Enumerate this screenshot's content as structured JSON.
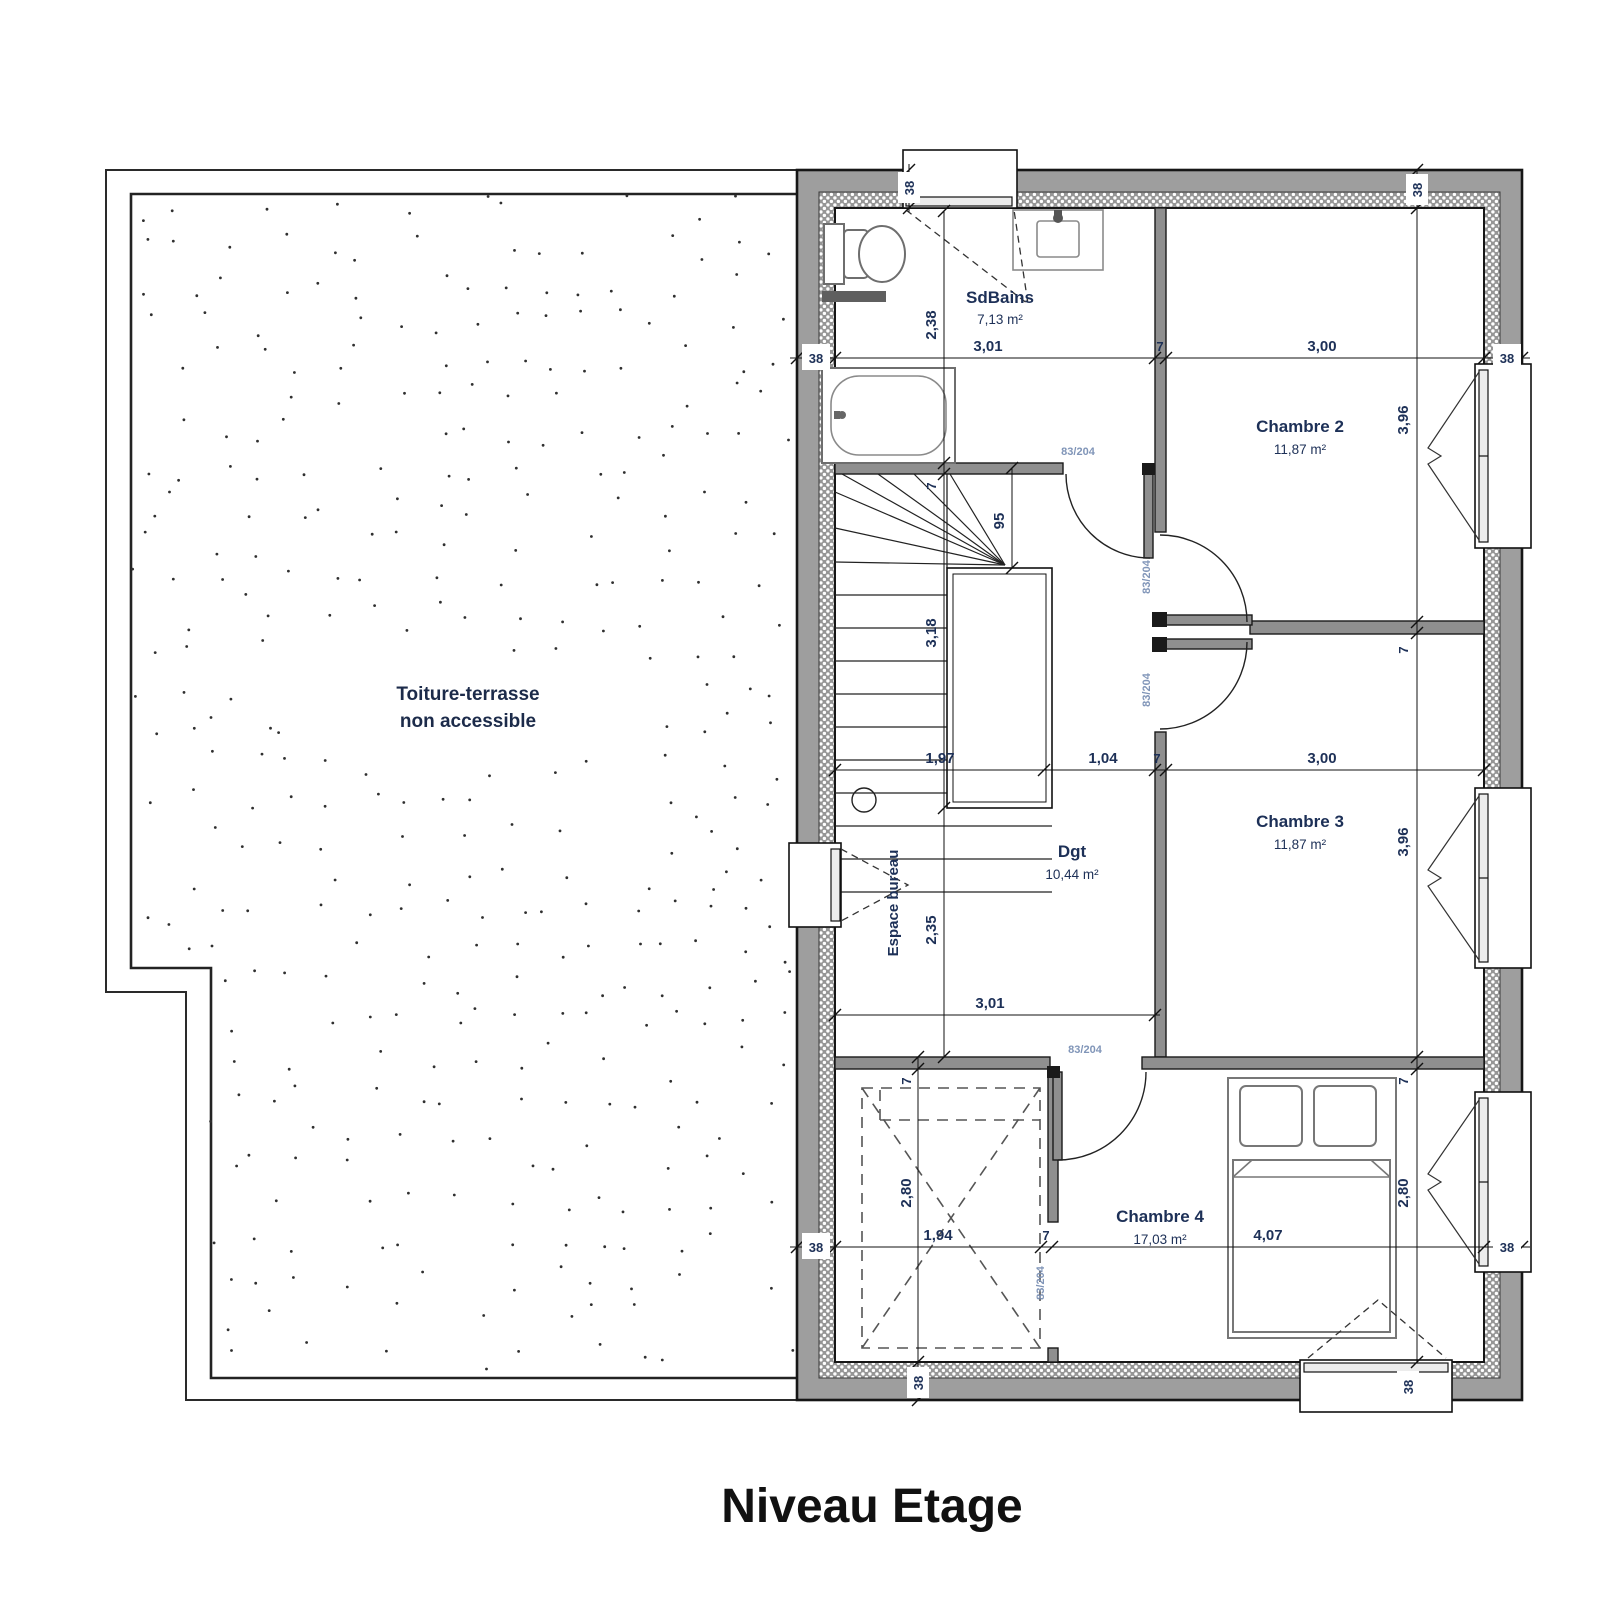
{
  "title": "Niveau Etage",
  "terrace": {
    "line1": "Toiture-terrasse",
    "line2": "non accessible"
  },
  "rooms": {
    "sdbains": {
      "name": "SdBains",
      "area": "7,13 m²"
    },
    "chambre2": {
      "name": "Chambre 2",
      "area": "11,87 m²"
    },
    "dgt": {
      "name": "Dgt",
      "area": "10,44 m²"
    },
    "chambre3": {
      "name": "Chambre 3",
      "area": "11,87 m²"
    },
    "chambre4": {
      "name": "Chambre 4",
      "area": "17,03 m²"
    },
    "bureau": {
      "name": "Espace bureau"
    }
  },
  "door_label": "83/204",
  "dims": {
    "wall_38_top_left": "38",
    "wall_38_top_right": "38",
    "wall_38_bottom_left": "38",
    "wall_38_bottom_window": "38",
    "top_chain": {
      "left_38": "38",
      "w1": "3,01",
      "w2": "7",
      "w3": "3,00",
      "right_38": "38"
    },
    "mid_chain": {
      "w1": "1,97",
      "w2": "1,04",
      "w3": "7",
      "w4": "3,00"
    },
    "bureau_chain": {
      "w1": "3,01"
    },
    "bottom_chain": {
      "left_38": "38",
      "w1": "1,94",
      "w2": "7",
      "w3": "4,07",
      "right_38": "38"
    },
    "left_col": {
      "sdb_h": "2,38",
      "sdb_wall": "7",
      "stair_w": "95",
      "stair_h": "3,18",
      "bureau_h": "2,35",
      "ch4_wall": "7",
      "ch4_h": "2,80"
    },
    "right_col": {
      "ch2_h": "3,96",
      "sep_wall": "7",
      "ch3_h": "3,96",
      "ch4_wall": "7",
      "ch4_h": "2,80"
    }
  },
  "colors": {
    "wall_fill": "#9e9e9e",
    "insulation": "#969696",
    "dim_text": "#1d3057",
    "door_text": "#8095b8",
    "room_text": "#1d3057"
  }
}
